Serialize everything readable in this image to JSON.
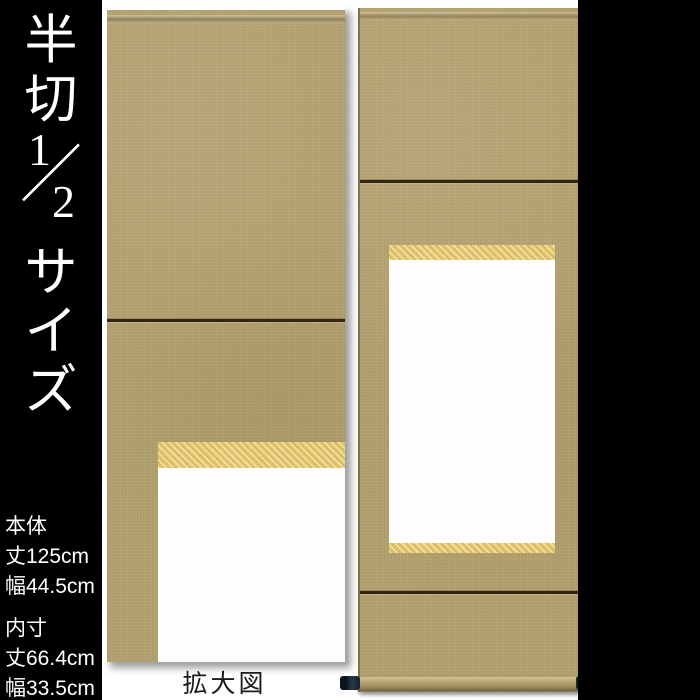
{
  "colors": {
    "page_bg": "#ffffff",
    "panel_bg": "#000000",
    "text_white": "#ffffff",
    "caption_text": "#1c1c1c",
    "fabric": "#b2a06e",
    "gold_band": "#e2c369",
    "divider_line": "#33260f",
    "blank_panel": "#fefefe",
    "roller_knob": "#15222c"
  },
  "left_panel": {
    "size_title": {
      "chars_top": [
        "半",
        "切"
      ],
      "fraction": {
        "numerator": "1",
        "slash": "／",
        "denominator": "2"
      },
      "chars_bottom": [
        "サ",
        "イ",
        "ズ"
      ]
    },
    "specs": {
      "body": {
        "label": "本体",
        "length": "丈125cm",
        "width": "幅44.5cm"
      },
      "inner": {
        "label": "内寸",
        "length": "丈66.4cm",
        "width": "幅33.5cm"
      }
    }
  },
  "right_panel": {
    "product_title": {
      "chars": [
        "白",
        "抜",
        "掛",
        "軸"
      ]
    }
  },
  "enlarged_view": {
    "caption": "拡大図"
  }
}
